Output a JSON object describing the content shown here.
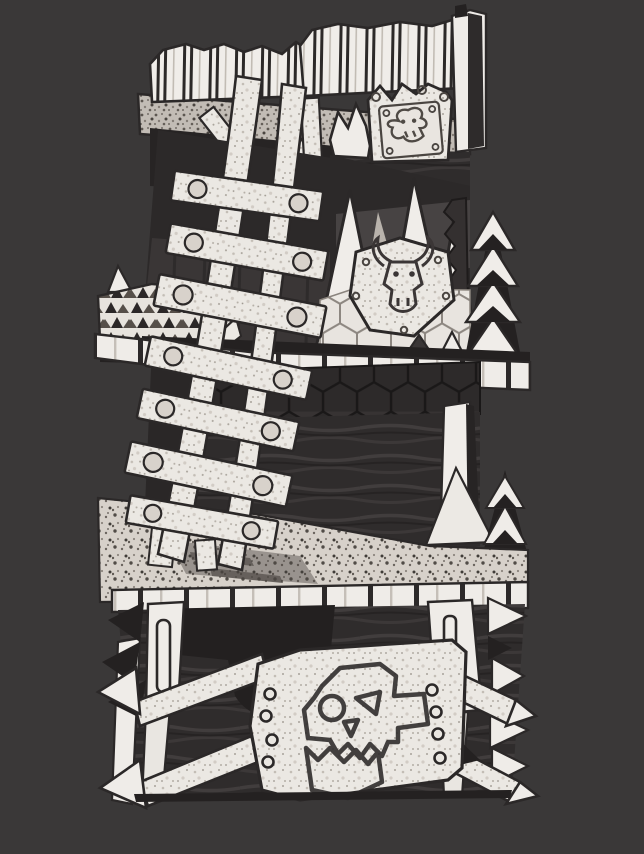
{
  "subject": "Monochrome sketch-shaded 3D render of a ramshackle orc watchtower miniature on a dark neutral backdrop",
  "palette": {
    "background": "#3a3838",
    "ink": "#2b2828",
    "paper": "#efece8",
    "paper_texture": "#c9c3bc",
    "gray_wall": "#474343",
    "dark_wall": "#2d2a2a",
    "darkest": "#242121",
    "floor": "#d7d1ca"
  },
  "scene": {
    "levels": [
      {
        "name": "roof-level",
        "parts": [
          "corrugated-roof-panel",
          "corner-support-post",
          "ledge-shelf",
          "jagged-crown-plate",
          "riveted-glyph-plate"
        ]
      },
      {
        "name": "upper-level",
        "parts": [
          "plank-ladder",
          "tall-spike-palisade",
          "horned-skull-shield",
          "honeycomb-mesh-fence",
          "serrated-blade",
          "chevron-spike-stack",
          "spiked-side-platform"
        ]
      },
      {
        "name": "mid-level",
        "parts": [
          "plank-edge-trim",
          "honeycomb-mesh-band",
          "plank-wall",
          "support-pillar",
          "deck-floor"
        ]
      },
      {
        "name": "base-level",
        "parts": [
          "plank-edge-trim",
          "plank-wall",
          "corner-posts",
          "skull-and-crossbones-plaque",
          "arrow-tipped-planks",
          "side-spikes"
        ]
      }
    ]
  },
  "glyphs": [
    "ork-skull-glyph",
    "horned-bull-skull-glyph",
    "scratched-skull-glyph"
  ]
}
